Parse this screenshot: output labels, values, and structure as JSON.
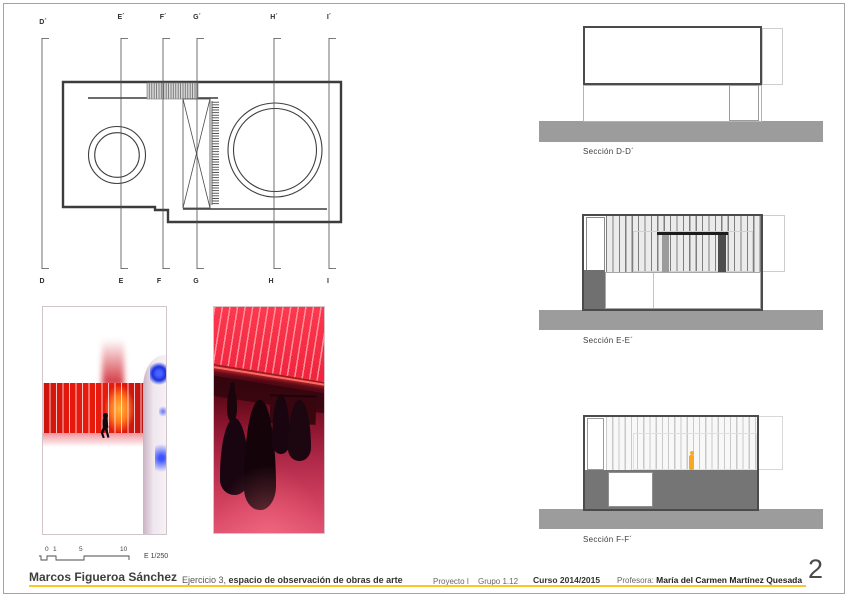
{
  "sheet": {
    "page_number": "2",
    "colors": {
      "accent": "#fcc62a",
      "ink": "#3d3d3d",
      "ground": "#9c9c9c",
      "photo_red": "#e8190d",
      "photo_blue": "#2b46f0",
      "highlight_orange": "#f9a825"
    }
  },
  "plan": {
    "markers": [
      {
        "top_label": "D´",
        "bottom_label": "D"
      },
      {
        "top_label": "E´",
        "bottom_label": "E"
      },
      {
        "top_label": "F´",
        "bottom_label": "F"
      },
      {
        "top_label": "G´",
        "bottom_label": "G"
      },
      {
        "top_label": "H´",
        "bottom_label": "H"
      },
      {
        "top_label": "I´",
        "bottom_label": "I"
      }
    ]
  },
  "sections": [
    {
      "label": "Sección D-D´"
    },
    {
      "label": "Sección E-E´"
    },
    {
      "label": "Sección F-F´"
    }
  ],
  "scale_bar": {
    "ticks": [
      "0",
      "1",
      "5",
      "10"
    ],
    "scale_label": "E 1/250"
  },
  "footer": {
    "author": "Marcos Figueroa Sánchez",
    "exercise_prefix": "Ejercicio 3,",
    "exercise_title": "espacio de observación de obras de arte",
    "project": "Proyecto I",
    "group": "Grupo 1.12",
    "course": "Curso 2014/2015",
    "professor_label": "Profesora:",
    "professor_name": "María del Carmen Martínez Quesada"
  }
}
